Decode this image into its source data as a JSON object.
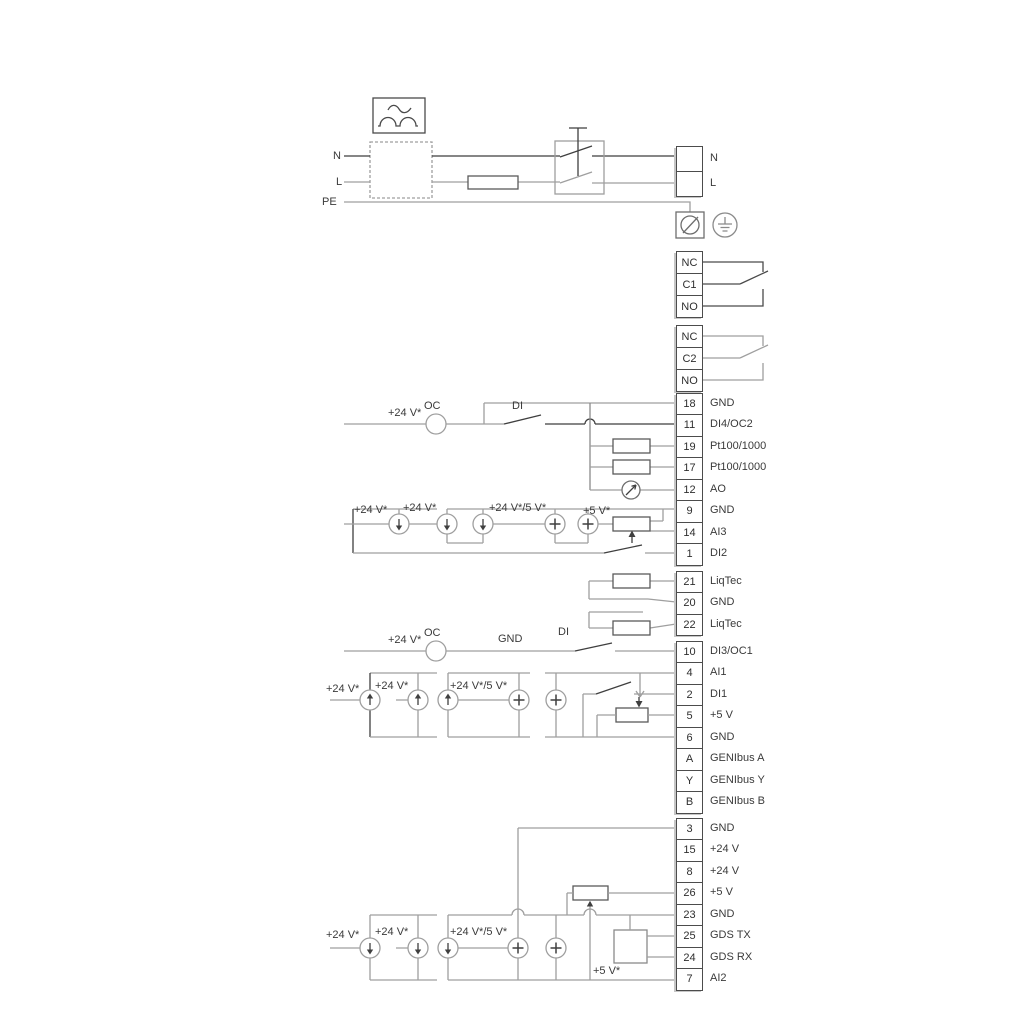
{
  "power": {
    "n_left": "N",
    "l_left": "L",
    "pe_left": "PE"
  },
  "labels": [
    "+24 V*",
    "OC",
    "DI",
    "+24 V*",
    "+24 V*",
    "+24 V*/5 V*",
    "+5 V*",
    "+24 V*",
    "OC",
    "GND",
    "DI",
    "+24 V*",
    "+24 V*",
    "+24 V*/5 V*",
    "+24 V*",
    "+24 V*",
    "+24 V*/5 V*",
    "+5 V*"
  ],
  "terminals": {
    "power_block": {
      "rows": [
        {
          "num": "",
          "label": "N"
        },
        {
          "num": "",
          "label": "L"
        }
      ]
    },
    "relay1": {
      "rows": [
        {
          "num": "NC",
          "label": ""
        },
        {
          "num": "C1",
          "label": ""
        },
        {
          "num": "NO",
          "label": ""
        }
      ]
    },
    "relay2": {
      "rows": [
        {
          "num": "NC",
          "label": ""
        },
        {
          "num": "C2",
          "label": ""
        },
        {
          "num": "NO",
          "label": ""
        }
      ]
    },
    "io_top": {
      "rows": [
        {
          "num": "18",
          "label": "GND"
        },
        {
          "num": "11",
          "label": "DI4/OC2"
        },
        {
          "num": "19",
          "label": "Pt100/1000"
        },
        {
          "num": "17",
          "label": "Pt100/1000"
        },
        {
          "num": "12",
          "label": "AO"
        },
        {
          "num": "9",
          "label": "GND"
        },
        {
          "num": "14",
          "label": "AI3"
        },
        {
          "num": "1",
          "label": "DI2"
        }
      ]
    },
    "liqtec": {
      "rows": [
        {
          "num": "21",
          "label": "LiqTec"
        },
        {
          "num": "20",
          "label": "GND"
        },
        {
          "num": "22",
          "label": "LiqTec"
        }
      ]
    },
    "io_mid": {
      "rows": [
        {
          "num": "10",
          "label": "DI3/OC1"
        },
        {
          "num": "4",
          "label": "AI1"
        },
        {
          "num": "2",
          "label": "DI1"
        },
        {
          "num": "5",
          "label": "+5 V"
        },
        {
          "num": "6",
          "label": "GND"
        },
        {
          "num": "A",
          "label": "GENIbus A"
        },
        {
          "num": "Y",
          "label": "GENIbus Y"
        },
        {
          "num": "B",
          "label": "GENIbus B"
        }
      ]
    },
    "io_bottom": {
      "rows": [
        {
          "num": "3",
          "label": "GND"
        },
        {
          "num": "15",
          "label": "+24 V"
        },
        {
          "num": "8",
          "label": "+24 V"
        },
        {
          "num": "26",
          "label": "+5 V"
        },
        {
          "num": "23",
          "label": "GND"
        },
        {
          "num": "25",
          "label": "GDS TX"
        },
        {
          "num": "24",
          "label": "GDS RX"
        },
        {
          "num": "7",
          "label": "AI2"
        }
      ]
    }
  },
  "colors": {
    "wire_gray": "#9f9f9f",
    "wire_dark": "#3f3f3f",
    "component": "#5a5a5a"
  }
}
